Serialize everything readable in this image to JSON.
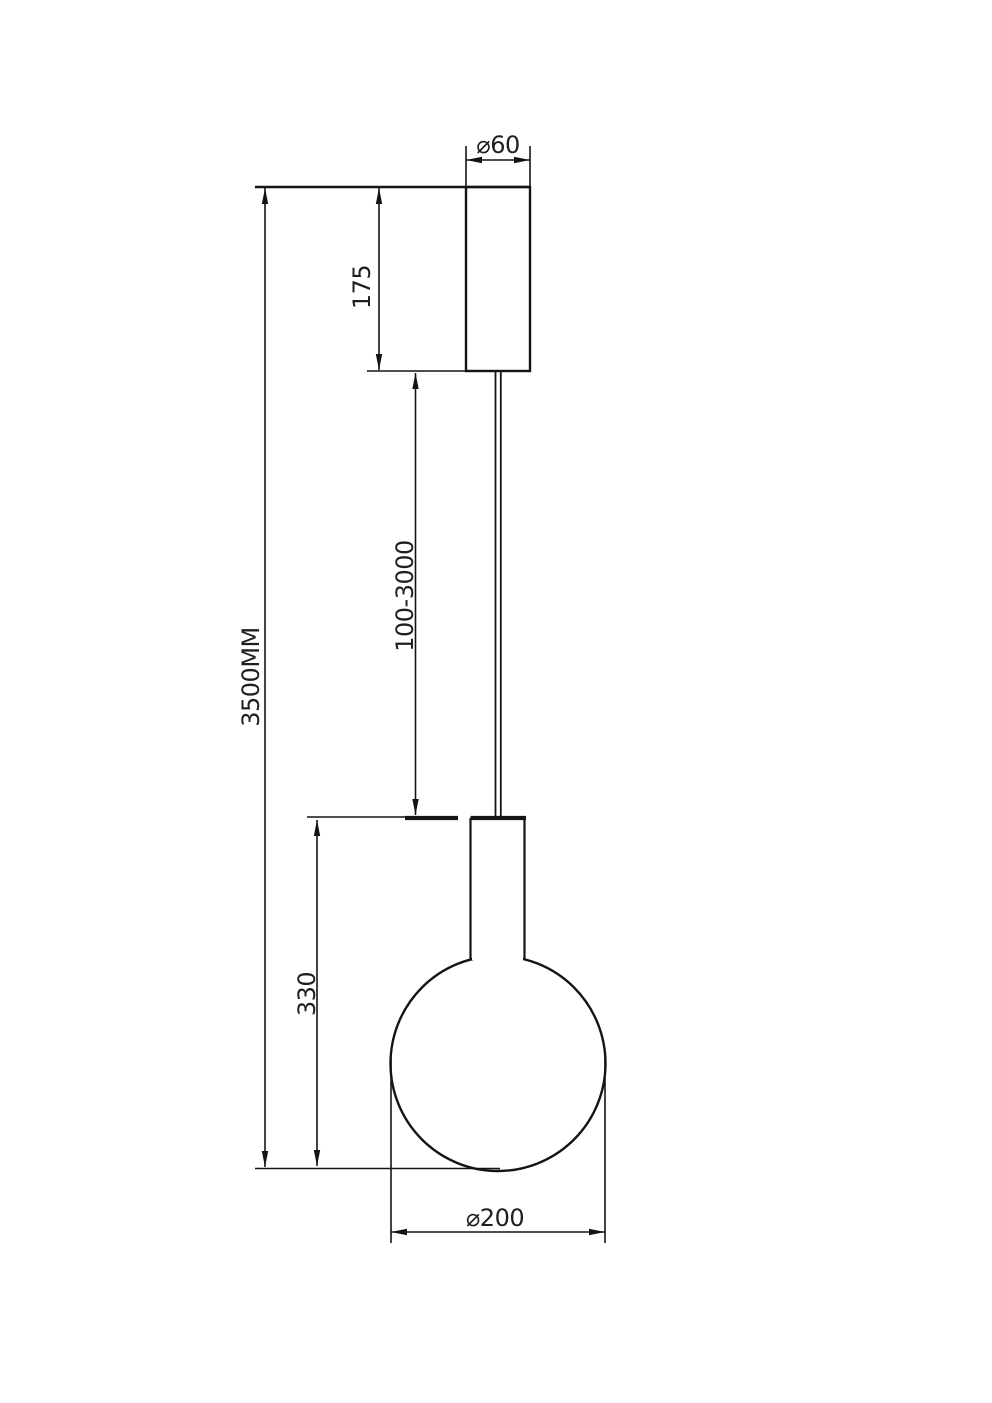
{
  "drawing": {
    "description": "Technical dimension drawing of a pendant lamp (ceiling canopy, suspension cable, globe bulb shade)",
    "unit_hint": "MM",
    "labels": {
      "canopy_diameter": "⌀60",
      "canopy_height": "175",
      "suspension_length": "100-3000",
      "overall_height": "3500MM",
      "shade_height": "330",
      "shade_diameter": "⌀200"
    },
    "colors": {
      "line": "#141414",
      "text": "#1f1f1f",
      "background": "#ffffff"
    }
  }
}
